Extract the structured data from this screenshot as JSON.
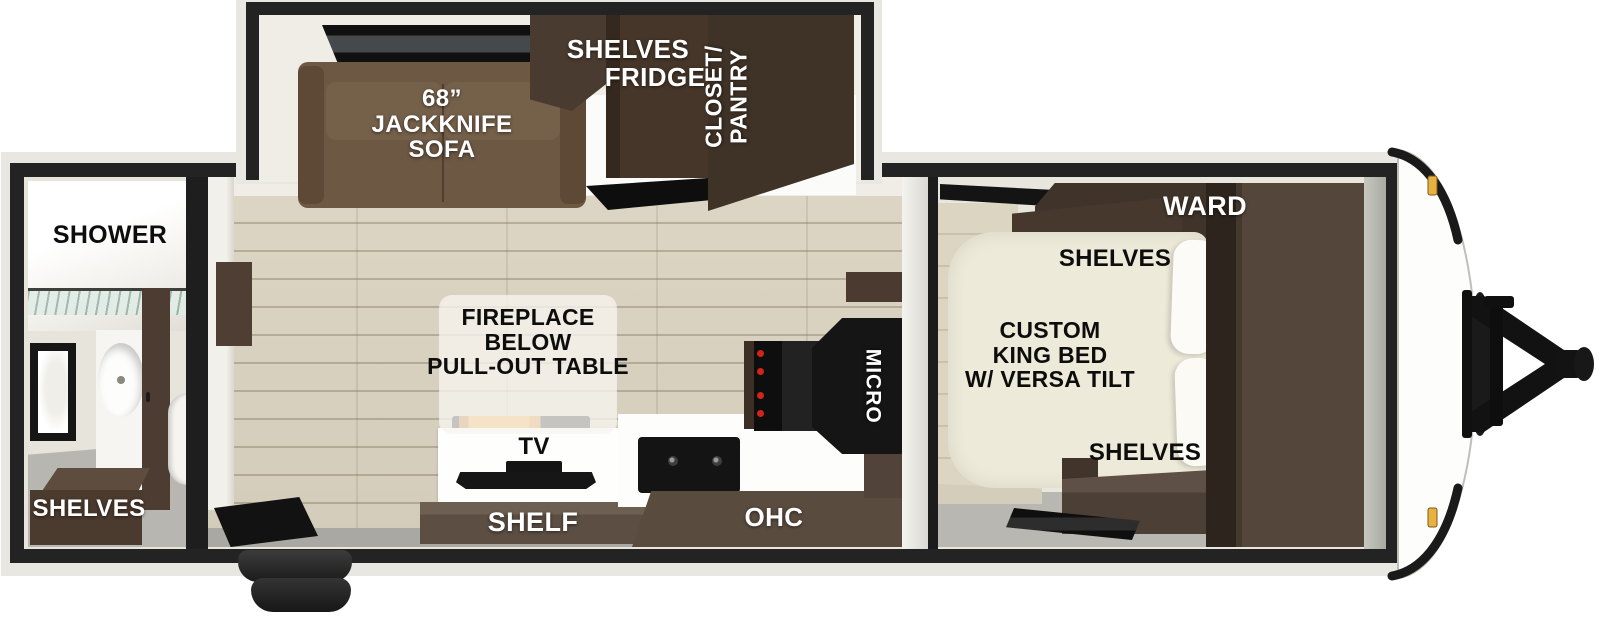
{
  "floorplan": {
    "slideout": {
      "sofa_line1": "68”",
      "sofa_line2": "JACKKNIFE",
      "sofa_line3": "SOFA",
      "shelves": "SHELVES",
      "fridge": "FRIDGE",
      "closet_line1": "CLOSET/",
      "closet_line2": "PANTRY"
    },
    "bathroom": {
      "shower": "SHOWER",
      "shelves": "SHELVES"
    },
    "living": {
      "fireplace_line1": "FIREPLACE",
      "fireplace_line2": "BELOW",
      "fireplace_line3": "PULL-OUT TABLE",
      "tv": "TV",
      "shelf": "SHELF",
      "ohc": "OHC",
      "micro": "MICRO"
    },
    "bedroom": {
      "ward": "WARD",
      "shelves_upper": "SHELVES",
      "bed_line1": "CUSTOM",
      "bed_line2": "KING BED",
      "bed_line3": "W/ VERSA TILT",
      "shelves_lower": "SHELVES"
    },
    "colors": {
      "outline_black": "#232323",
      "wall_cream": "#e9e6de",
      "wood_floor": "#d8d1c0",
      "gray_floor": "#b7b6b1",
      "sofa_brown": "#6c5843",
      "dark_cabinet": "#443529",
      "shelf_brown": "#605246",
      "bed_cream": "#edead9",
      "flame_orange": "#f09c31",
      "marker_amber": "#e9b13f",
      "knob_red": "#d32517"
    }
  }
}
